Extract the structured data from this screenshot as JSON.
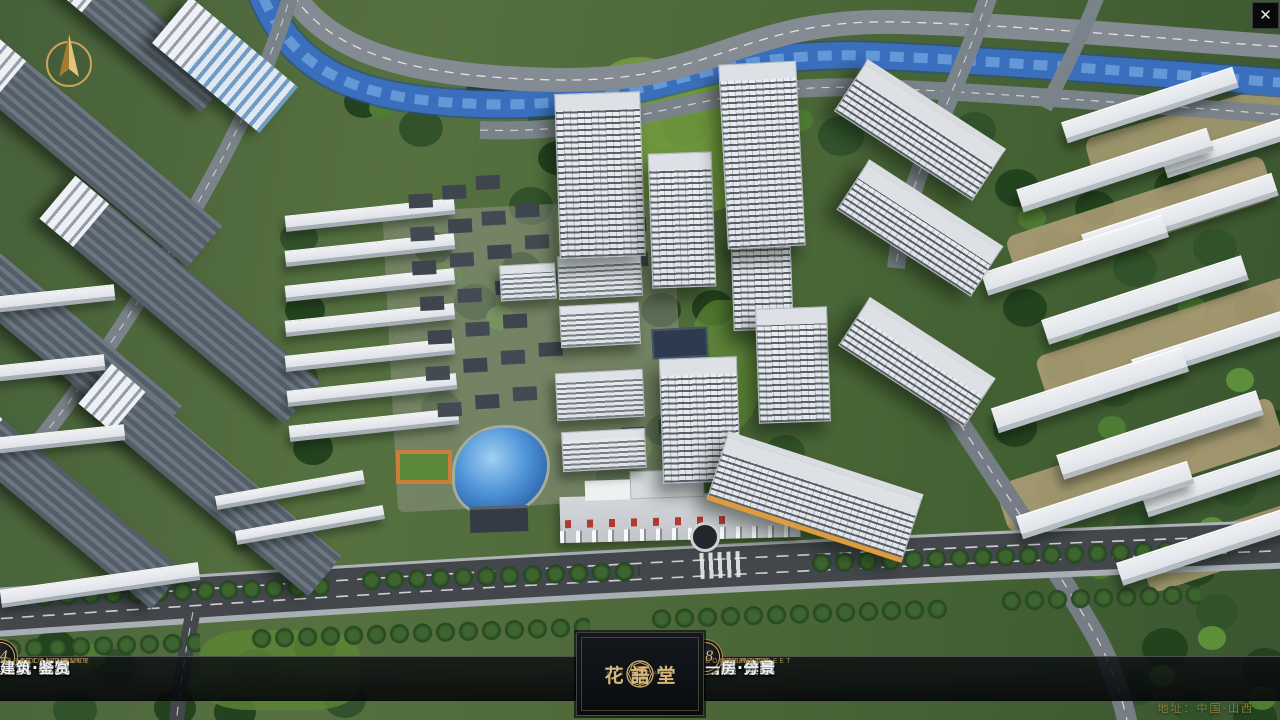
{
  "theme": {
    "gold": "#c9a86a",
    "gold-dim": "#9c8149",
    "gold-text": "#d8b878",
    "bar-bg": "rgba(12,15,18,0.82)",
    "label": "#f1f2f3"
  },
  "window": {
    "close_glyph": "✕"
  },
  "scene": {
    "colors": {
      "grass": "#4c6a38",
      "trees": "#2c4a24",
      "river": "#3a6fbe",
      "road": "#7b838a",
      "main_road": "#43474c",
      "tower": "#e9ecef",
      "gray_slab": "#5f6973",
      "pond": "#4e93d8",
      "tan_path": "#b2a078"
    }
  },
  "navbar": {
    "items": [
      {
        "number": "o1",
        "label": "品牌·介绍",
        "sublabel": "BRAND SUPPORT"
      },
      {
        "number": "o2",
        "label": "区位·价值",
        "sublabel": "LOCATION VALUE"
      },
      {
        "number": "o3",
        "label": "项目·概况",
        "sublabel": "PROJECT SURVEY"
      },
      {
        "number": "o4",
        "label": "建筑·鉴赏",
        "sublabel": "APPRECIATION"
      },
      {
        "number": "o5",
        "label": "园林·景观",
        "sublabel": "GARDEN STREET"
      },
      {
        "number": "o6",
        "label": "精装·体验",
        "sublabel": "EXPERIENCE"
      },
      {
        "number": "o7",
        "label": "户型·分布",
        "sublabel": "SHOW ROOM"
      },
      {
        "number": "o8",
        "label": "一房·一景",
        "sublabel": "COMMUNITY"
      }
    ]
  },
  "logo": {
    "title": "花語堂",
    "subtitle": "HUA YU TANG"
  },
  "footer": {
    "address": "地址：中国·山西"
  }
}
